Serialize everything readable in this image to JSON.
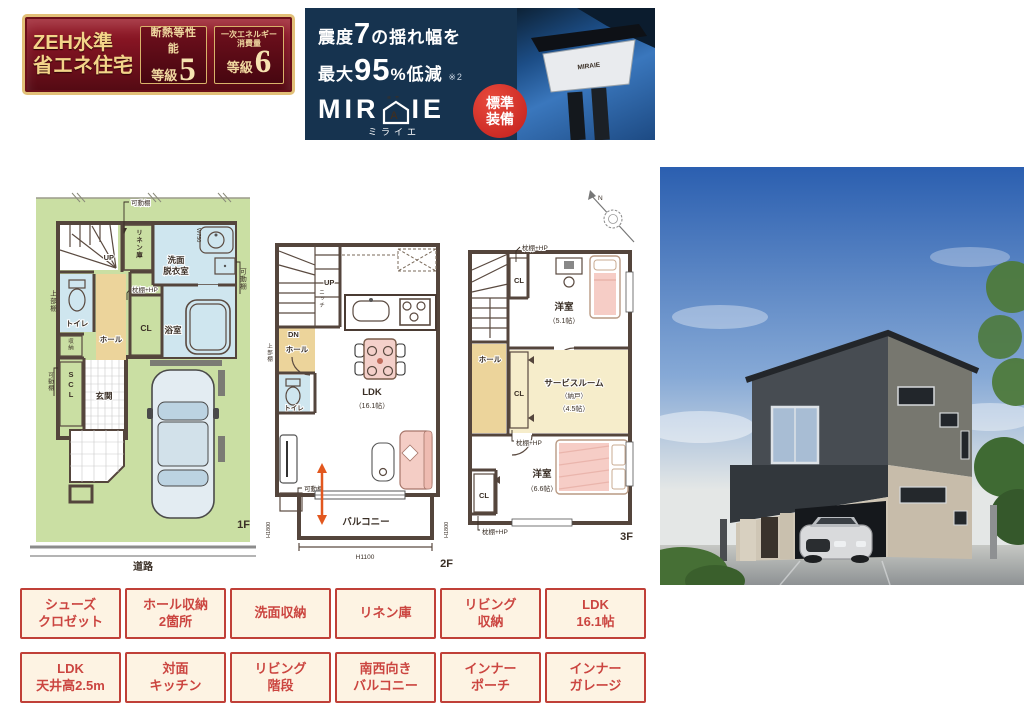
{
  "zeh_badge": {
    "title_line1": "ZEH水準",
    "title_line2": "省エネ住宅",
    "insulation": {
      "label": "断熱等性能",
      "grade_prefix": "等級",
      "grade_value": "5"
    },
    "energy": {
      "label_line1": "一次エネルギー",
      "label_line2": "消費量",
      "grade_prefix": "等級",
      "grade_value": "6"
    }
  },
  "miraie_banner": {
    "headline": {
      "pre": "震度",
      "big": "7",
      "post": "の揺れ幅を"
    },
    "subline": {
      "pre": "最大",
      "big": "95",
      "unit": "%",
      "post": "低減",
      "note": "※2"
    },
    "logo": {
      "left": "MIR",
      "house_letter": "A",
      "right": "IE",
      "quotes": "“ ”",
      "kana": "ミライエ"
    },
    "standard_badge": {
      "line1": "標準",
      "line2": "装備"
    },
    "device_label": "MIRAIE"
  },
  "plans": {
    "common": {
      "up": "UP",
      "dn": "DN",
      "hall": "ホール",
      "toilet": "トイレ",
      "cl": "CL",
      "kadoudana": "可動棚",
      "makuradana_hp": "枕棚+HP",
      "joubudana": "上部棚",
      "yoshitsu": "洋室"
    },
    "f1": {
      "floor_label": "1F",
      "road": "道路",
      "linen": "リネン庫",
      "wash_line1": "洗面",
      "wash_line2": "脱衣室",
      "w750": "W750",
      "bath": "浴室",
      "storage": "収納",
      "scl": "SCL",
      "genkan": "玄関"
    },
    "f2": {
      "floor_label": "2F",
      "niche": "ニッチ",
      "ldk": "LDK",
      "ldk_size": "（16.1帖）",
      "balcony": "バルコニー",
      "h1800": "H1800",
      "h1100": "H1100"
    },
    "f3": {
      "floor_label": "3F",
      "north": "N",
      "room51_size": "（5.1帖）",
      "service_line1": "サービスルーム",
      "service_line2": "（納戸）",
      "service_size": "（4.5帖）",
      "room66_size": "（6.6帖）"
    }
  },
  "feature_tags": [
    {
      "line1": "シューズ",
      "line2": "クロゼット"
    },
    {
      "line1": "ホール収納",
      "line2": "2箇所"
    },
    {
      "line1": "洗面収納",
      "line2": ""
    },
    {
      "line1": "リネン庫",
      "line2": ""
    },
    {
      "line1": "リビング",
      "line2": "収納"
    },
    {
      "line1": "LDK",
      "line2": "16.1帖"
    },
    {
      "line1": "LDK",
      "line2": "天井高2.5m"
    },
    {
      "line1": "対面",
      "line2": "キッチン"
    },
    {
      "line1": "リビング",
      "line2": "階段"
    },
    {
      "line1": "南西向き",
      "line2": "バルコニー"
    },
    {
      "line1": "インナー",
      "line2": "ポーチ"
    },
    {
      "line1": "インナー",
      "line2": "ガレージ"
    }
  ],
  "colors": {
    "badge_red": "#7c1220",
    "badge_gold": "#e2c078",
    "banner_navy": "#16334f",
    "standard_red": "#c21f1c",
    "tag_red": "#c04038",
    "tag_bg": "#fdf3e3",
    "plan_wall": "#54453c",
    "plan_floor": "#f3e2bd",
    "plan_wet": "#cfe6ef",
    "plan_closet": "#f6cfc2",
    "lot_green": "#cadfa3"
  }
}
